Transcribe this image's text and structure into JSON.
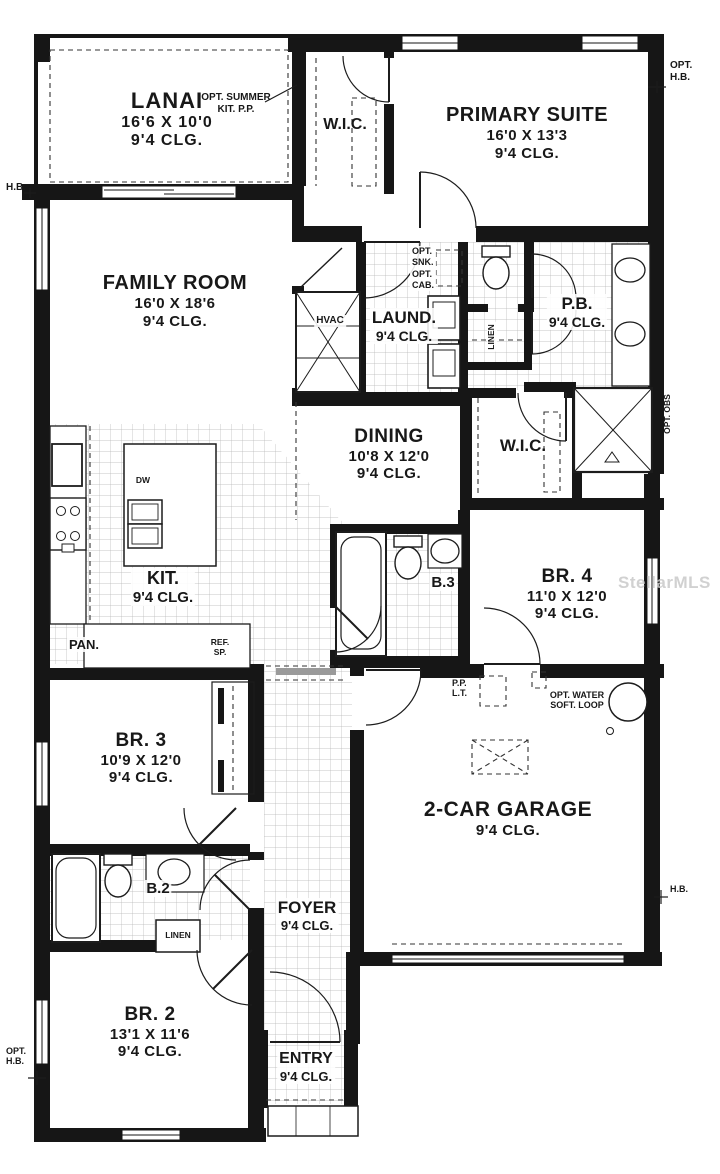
{
  "watermark": "StellarMLS",
  "rooms": {
    "lanai": {
      "name": "LANAI",
      "dims": "16'6 X 10'0",
      "clg": "9'4 CLG."
    },
    "primary_suite": {
      "name": "PRIMARY SUITE",
      "dims": "16'0 X 13'3",
      "clg": "9'4 CLG."
    },
    "wic_top": {
      "name": "W.I.C."
    },
    "family_room": {
      "name": "FAMILY ROOM",
      "dims": "16'0 X 18'6",
      "clg": "9'4 CLG."
    },
    "laundry": {
      "name": "LAUND.",
      "clg": "9'4 CLG."
    },
    "powder_bath": {
      "name": "P.B.",
      "clg": "9'4 CLG."
    },
    "dining": {
      "name": "DINING",
      "dims": "10'8 X 12'0",
      "clg": "9'4 CLG."
    },
    "wic_middle": {
      "name": "W.I.C."
    },
    "kitchen": {
      "name": "KIT.",
      "clg": "9'4 CLG."
    },
    "bath3": {
      "name": "B.3"
    },
    "bedroom4": {
      "name": "BR. 4",
      "dims": "11'0 X 12'0",
      "clg": "9'4 CLG."
    },
    "bedroom3": {
      "name": "BR. 3",
      "dims": "10'9 X 12'0",
      "clg": "9'4 CLG."
    },
    "garage": {
      "name": "2-CAR GARAGE",
      "clg": "9'4 CLG."
    },
    "bath2": {
      "name": "B.2"
    },
    "foyer": {
      "name": "FOYER",
      "clg": "9'4 CLG."
    },
    "bedroom2": {
      "name": "BR. 2",
      "dims": "13'1 X 11'6",
      "clg": "9'4 CLG."
    },
    "entry": {
      "name": "ENTRY",
      "clg": "9'4 CLG."
    }
  },
  "callouts": {
    "opt_summer_kit": {
      "line1": "OPT. SUMMER",
      "line2": "KIT. P.P."
    },
    "opt_hb_top": {
      "line1": "OPT.",
      "line2": "H.B."
    },
    "hb_left": "H.B.",
    "opt_snk": {
      "line1": "OPT.",
      "line2": "SNK.",
      "line3": "OPT.",
      "line4": "CAB."
    },
    "linen_hall": "LINEN",
    "opt_obs": "OPT. OBS",
    "hvac": "HVAC",
    "pan": "PAN.",
    "ref_sp": {
      "line1": "REF.",
      "line2": "SP."
    },
    "dw": "DW",
    "pp_lt": {
      "line1": "P.P.",
      "line2": "L.T."
    },
    "opt_water_soft": {
      "line1": "OPT. WATER",
      "line2": "SOFT. LOOP"
    },
    "hb_right": "H.B.",
    "linen_b2": "LINEN",
    "opt_hb_bottom": {
      "line1": "OPT.",
      "line2": "H.B."
    }
  },
  "colors": {
    "wall": "#161616",
    "tile_line": "#b5b5b5",
    "dash": "#333333",
    "watermark": "#c9c9c9"
  }
}
